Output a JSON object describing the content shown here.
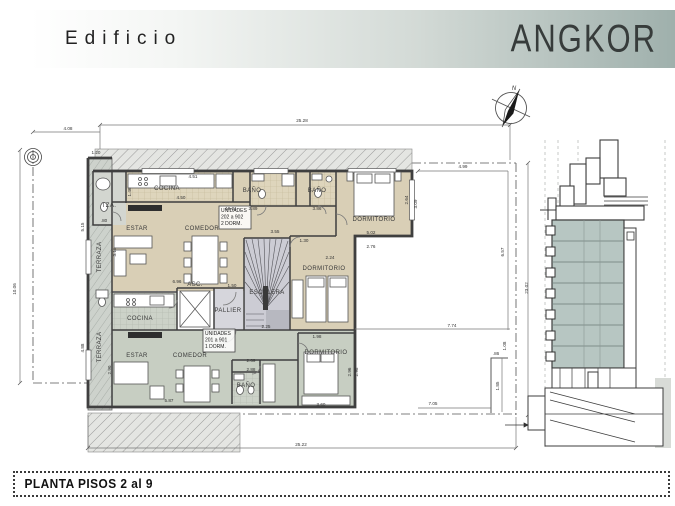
{
  "banner": {
    "prefix": "Edificio",
    "name": "ANGKOR"
  },
  "compass": {
    "north_label": "N"
  },
  "title_block": {
    "title": "PLANTA PISOS 2 al 9"
  },
  "colors": {
    "banner_gradient_end": "#9fb0ac",
    "unit_2dorm_floor": "#d9cfb6",
    "unit_1dorm_floor": "#c7cec2",
    "core_floor": "#ccccd4",
    "pallier_floor": "#d6d6dc",
    "terrace_strip": "#cdd2cc",
    "section_body": "#b7c6c2",
    "wall": "#3f3f3f"
  },
  "plan": {
    "unit_tags": [
      {
        "x": 221,
        "y": 212,
        "lines": [
          "UNIDADES",
          "202 a 902",
          "2 DORM."
        ]
      },
      {
        "x": 205,
        "y": 335,
        "lines": [
          "UNIDADES",
          "201 a 901",
          "1 DORM."
        ]
      }
    ],
    "room_labels": [
      {
        "t": "TZA.",
        "x": 109,
        "y": 207,
        "s": 4.5
      },
      {
        "t": "COCINA",
        "x": 167,
        "y": 190,
        "s": 5.5
      },
      {
        "t": "BAÑO",
        "x": 252,
        "y": 192,
        "s": 5
      },
      {
        "t": "BAÑO",
        "x": 317,
        "y": 192,
        "s": 5
      },
      {
        "t": "DORMITORIO",
        "x": 374,
        "y": 221,
        "s": 5.5
      },
      {
        "t": "ESTAR",
        "x": 137,
        "y": 230
      },
      {
        "t": "COMEDOR",
        "x": 202,
        "y": 230
      },
      {
        "t": "TERRAZA",
        "x": 101,
        "y": 257,
        "r": -90,
        "s": 5
      },
      {
        "t": "TERRAZA",
        "x": 101,
        "y": 347,
        "r": -90,
        "s": 5
      },
      {
        "t": "ESCALERA",
        "x": 267,
        "y": 294,
        "s": 5.5
      },
      {
        "t": "PALLIER",
        "x": 228,
        "y": 312,
        "s": 5
      },
      {
        "t": "ASC.",
        "x": 195,
        "y": 286,
        "s": 4
      },
      {
        "t": "DORMITORIO",
        "x": 324,
        "y": 270,
        "s": 5.5
      },
      {
        "t": "COCINA",
        "x": 140,
        "y": 320,
        "s": 5.5
      },
      {
        "t": "ESTAR",
        "x": 137,
        "y": 357
      },
      {
        "t": "COMEDOR",
        "x": 190,
        "y": 357
      },
      {
        "t": "BAÑO",
        "x": 246,
        "y": 387,
        "s": 5
      },
      {
        "t": "DORMITORIO",
        "x": 326,
        "y": 354,
        "s": 5.5
      }
    ],
    "dimensions": [
      {
        "t": "25.28",
        "x": 302,
        "y": 122
      },
      {
        "t": "4.08",
        "x": 68,
        "y": 130
      },
      {
        "t": "1.20",
        "x": 96,
        "y": 154
      },
      {
        "t": "4.51",
        "x": 193,
        "y": 178
      },
      {
        "t": "4.50",
        "x": 181,
        "y": 199
      },
      {
        "t": "19.01",
        "x": 231,
        "y": 210
      },
      {
        "t": "2.89",
        "x": 253,
        "y": 210
      },
      {
        "t": "3.86",
        "x": 317,
        "y": 210
      },
      {
        "t": ".80",
        "x": 104,
        "y": 222
      },
      {
        "t": "5.02",
        "x": 371,
        "y": 234
      },
      {
        "t": "2.76",
        "x": 371,
        "y": 248
      },
      {
        "t": "2.64",
        "x": 408,
        "y": 200,
        "r": -90
      },
      {
        "t": "3.09",
        "x": 417,
        "y": 204,
        "r": -90
      },
      {
        "t": "4.99",
        "x": 463,
        "y": 168
      },
      {
        "t": "6.57",
        "x": 504,
        "y": 252,
        "r": -90
      },
      {
        "t": "23.02",
        "x": 528,
        "y": 288,
        "r": -90
      },
      {
        "t": "7.74",
        "x": 452,
        "y": 327
      },
      {
        "t": "1.08",
        "x": 506,
        "y": 346,
        "r": -90
      },
      {
        "t": ".86",
        "x": 496,
        "y": 355
      },
      {
        "t": "1.85",
        "x": 499,
        "y": 386,
        "r": -90
      },
      {
        "t": "7.05",
        "x": 433,
        "y": 405
      },
      {
        "t": "25.22",
        "x": 301,
        "y": 446
      },
      {
        "t": "10.06",
        "x": 16,
        "y": 289,
        "r": -90
      },
      {
        "t": "5.15",
        "x": 84,
        "y": 227,
        "r": -90
      },
      {
        "t": "3.18",
        "x": 116,
        "y": 252,
        "r": -90
      },
      {
        "t": "4.88",
        "x": 84,
        "y": 348,
        "r": -90
      },
      {
        "t": "2.90",
        "x": 111,
        "y": 370,
        "r": -90
      },
      {
        "t": "1.46",
        "x": 131,
        "y": 192,
        "r": -90
      },
      {
        "t": "6.96",
        "x": 177,
        "y": 283
      },
      {
        "t": "1.50",
        "x": 232,
        "y": 287
      },
      {
        "t": "3.55",
        "x": 275,
        "y": 233
      },
      {
        "t": "1.30",
        "x": 304,
        "y": 242
      },
      {
        "t": "2.24",
        "x": 330,
        "y": 259
      },
      {
        "t": "2.25",
        "x": 266,
        "y": 328
      },
      {
        "t": "2.69",
        "x": 251,
        "y": 362
      },
      {
        "t": "2.88",
        "x": 251,
        "y": 371
      },
      {
        "t": "1.98",
        "x": 317,
        "y": 338
      },
      {
        "t": "2.96",
        "x": 351,
        "y": 372,
        "r": -90
      },
      {
        "t": "2.98",
        "x": 358,
        "y": 372,
        "r": -90
      },
      {
        "t": "3.60",
        "x": 321,
        "y": 406
      },
      {
        "t": "5.87",
        "x": 169,
        "y": 402
      }
    ]
  }
}
